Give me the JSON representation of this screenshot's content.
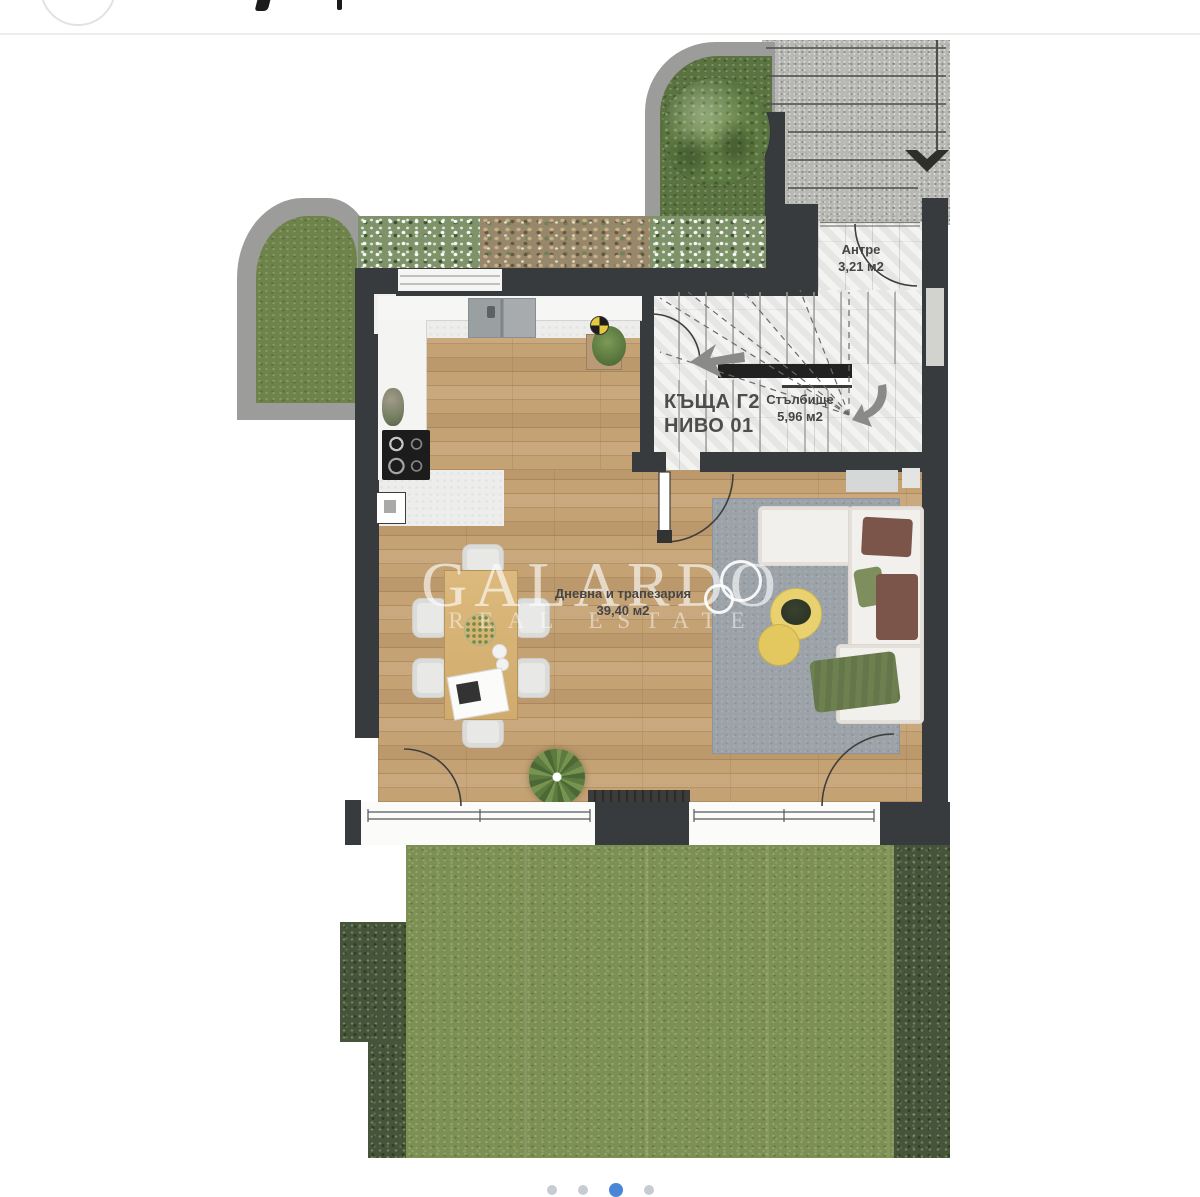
{
  "header": {
    "note": "cut-off gallery header strip",
    "divider_color": "#ededeb"
  },
  "floorplan": {
    "unit": {
      "line1": "КЪЩА Г2",
      "line2": "НИВО 01"
    },
    "rooms": {
      "antre": {
        "name": "Антре",
        "area": "3,21 м2"
      },
      "stairs": {
        "name": "Стълбище",
        "area": "5,96 м2"
      },
      "living": {
        "name": "Дневна и трапезария",
        "area": "39,40 м2"
      }
    },
    "watermark": {
      "brand": "GALARDO",
      "tagline": "REAL ESTATE"
    },
    "colors": {
      "wall": "#383b3e",
      "wood_floor": "#c5a274",
      "lawn": "#7d9054",
      "hedge": "#46553a",
      "granite": "#b7b7b4",
      "rug": "#9ba2a8",
      "coffee_table": "#ead16f",
      "sofa": "#f2f0ec"
    }
  },
  "carousel": {
    "dot_count": 4,
    "active_index": 2,
    "active_color": "#4a86d8",
    "inactive_color": "#c7ccd2"
  }
}
